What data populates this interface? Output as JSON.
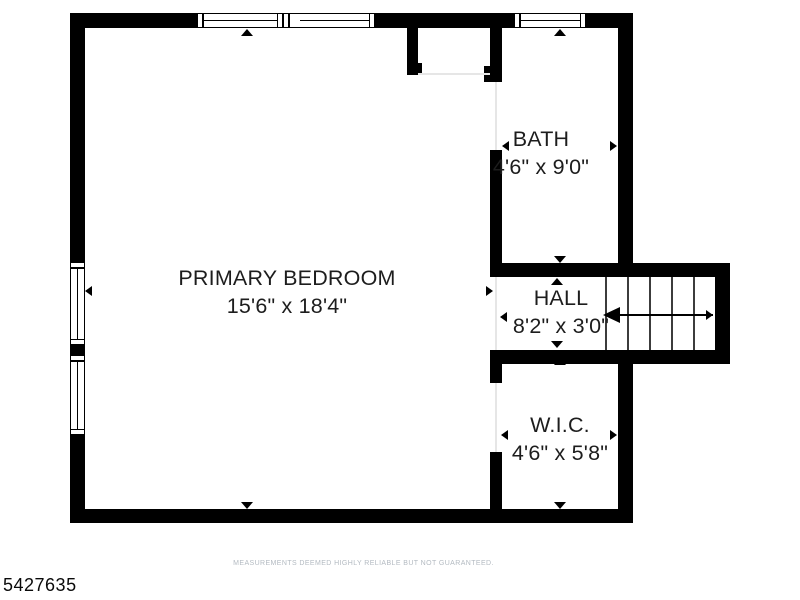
{
  "floorplan": {
    "mls_number": "5427635",
    "disclaimer": "MEASUREMENTS DEEMED HIGHLY RELIABLE BUT NOT GUARANTEED.",
    "rooms": [
      {
        "id": "primary-bedroom",
        "name": "PRIMARY BEDROOM",
        "dimensions": "15'6\" x 18'4\""
      },
      {
        "id": "bath",
        "name": "BATH",
        "dimensions": "4'6\" x 9'0\""
      },
      {
        "id": "hall",
        "name": "HALL",
        "dimensions": "8'2\" x 3'0\""
      },
      {
        "id": "wic",
        "name": "W.I.C.",
        "dimensions": "4'6\" x 5'8\""
      }
    ],
    "features": {
      "windows": [
        "top-wall-double-window",
        "top-wall-bath-window",
        "left-wall-double-window"
      ],
      "stairs": "staircase-right-of-hall",
      "wall_color": "#000000",
      "text_color": "#1d1d1d",
      "disclaimer_color": "#b3bac1"
    }
  }
}
